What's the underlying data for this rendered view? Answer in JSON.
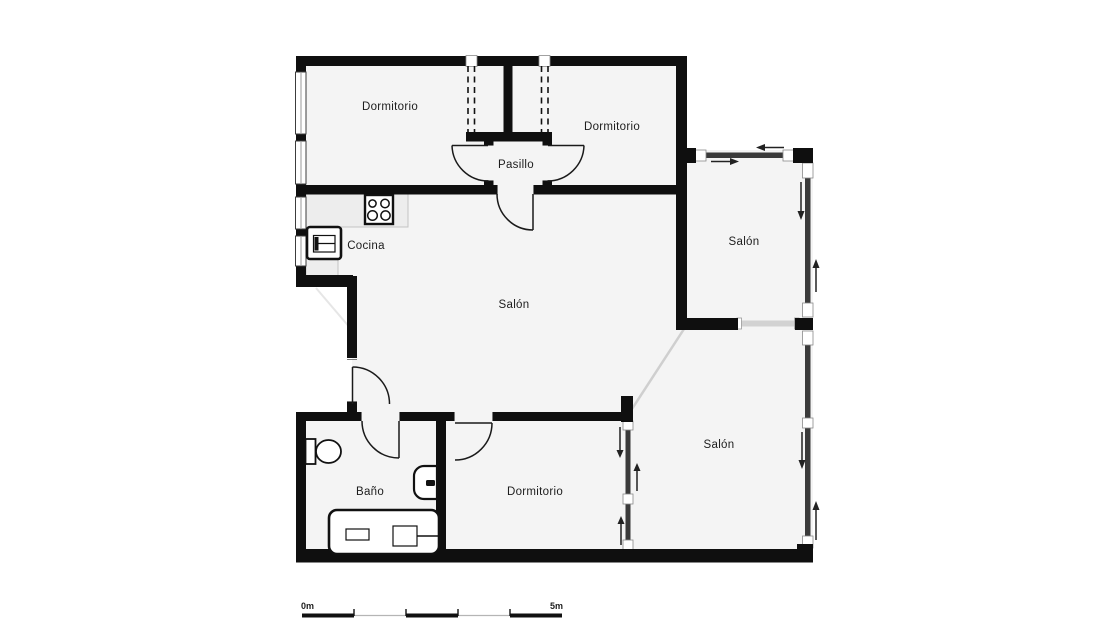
{
  "rooms": {
    "bedroom_top_left": {
      "label": "Dormitorio"
    },
    "bedroom_top_right": {
      "label": "Dormitorio"
    },
    "hallway": {
      "label": "Pasillo"
    },
    "kitchen": {
      "label": "Cocina"
    },
    "living_room_center": {
      "label": "Salón"
    },
    "living_room_top_right": {
      "label": "Salón"
    },
    "living_room_bottom_right": {
      "label": "Salón"
    },
    "bathroom": {
      "label": "Baño"
    },
    "bedroom_bottom": {
      "label": "Dormitorio"
    }
  },
  "scale_bar": {
    "start_label": "0m",
    "end_label": "5m"
  },
  "colors": {
    "wall": "#0f0f0f",
    "floor": "#f4f4f4",
    "glass_wall": "#3a3a3a",
    "opening_line": "#d2d2d2",
    "counter": "#ededed",
    "background": "#ffffff",
    "label_text": "#1d1d1d"
  }
}
